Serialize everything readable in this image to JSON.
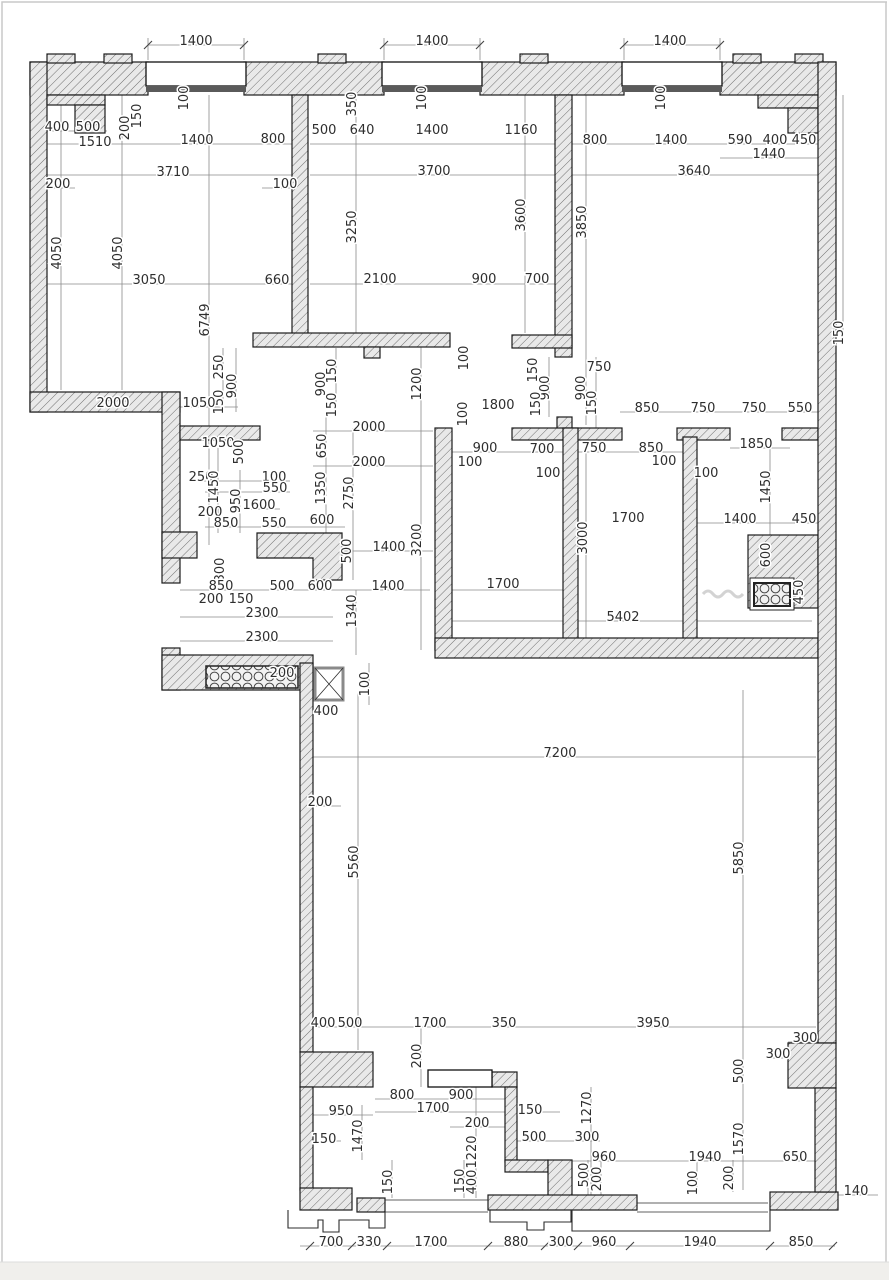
{
  "plan": {
    "kind": "architectural floor plan with dimension chains (mm)",
    "dimension_labels": [
      {
        "t": "1400",
        "x": 196,
        "y": 45
      },
      {
        "t": "1400",
        "x": 432,
        "y": 45
      },
      {
        "t": "1400",
        "x": 670,
        "y": 45
      },
      {
        "t": "100",
        "x": 188,
        "y": 98,
        "v": 1
      },
      {
        "t": "150",
        "x": 141,
        "y": 116,
        "v": 1
      },
      {
        "t": "200",
        "x": 129,
        "y": 128,
        "v": 1
      },
      {
        "t": "400",
        "x": 57,
        "y": 131
      },
      {
        "t": "500",
        "x": 88,
        "y": 131
      },
      {
        "t": "1510",
        "x": 95,
        "y": 146
      },
      {
        "t": "1400",
        "x": 197,
        "y": 144
      },
      {
        "t": "800",
        "x": 273,
        "y": 143
      },
      {
        "t": "350",
        "x": 356,
        "y": 104,
        "v": 1
      },
      {
        "t": "100",
        "x": 426,
        "y": 98,
        "v": 1
      },
      {
        "t": "500",
        "x": 324,
        "y": 134
      },
      {
        "t": "640",
        "x": 362,
        "y": 134
      },
      {
        "t": "1400",
        "x": 432,
        "y": 134
      },
      {
        "t": "1160",
        "x": 521,
        "y": 134
      },
      {
        "t": "800",
        "x": 595,
        "y": 144
      },
      {
        "t": "100",
        "x": 665,
        "y": 98,
        "v": 1
      },
      {
        "t": "1400",
        "x": 671,
        "y": 144
      },
      {
        "t": "590",
        "x": 740,
        "y": 144
      },
      {
        "t": "400",
        "x": 775,
        "y": 144
      },
      {
        "t": "450",
        "x": 804,
        "y": 144
      },
      {
        "t": "1440",
        "x": 769,
        "y": 158
      },
      {
        "t": "3710",
        "x": 173,
        "y": 176
      },
      {
        "t": "3700",
        "x": 434,
        "y": 175
      },
      {
        "t": "3640",
        "x": 694,
        "y": 175
      },
      {
        "t": "200",
        "x": 58,
        "y": 188
      },
      {
        "t": "100",
        "x": 285,
        "y": 188
      },
      {
        "t": "4050",
        "x": 61,
        "y": 253,
        "v": 1
      },
      {
        "t": "4050",
        "x": 122,
        "y": 253,
        "v": 1
      },
      {
        "t": "3250",
        "x": 356,
        "y": 227,
        "v": 1
      },
      {
        "t": "3600",
        "x": 525,
        "y": 215,
        "v": 1
      },
      {
        "t": "3850",
        "x": 586,
        "y": 222,
        "v": 1
      },
      {
        "t": "3050",
        "x": 149,
        "y": 284
      },
      {
        "t": "660",
        "x": 277,
        "y": 284
      },
      {
        "t": "2100",
        "x": 380,
        "y": 283
      },
      {
        "t": "900",
        "x": 484,
        "y": 283
      },
      {
        "t": "700",
        "x": 537,
        "y": 283
      },
      {
        "t": "150",
        "x": 843,
        "y": 333,
        "v": 1
      },
      {
        "t": "6749",
        "x": 209,
        "y": 320,
        "v": 1
      },
      {
        "t": "250",
        "x": 223,
        "y": 367,
        "v": 1
      },
      {
        "t": "900",
        "x": 236,
        "y": 386,
        "v": 1
      },
      {
        "t": "150",
        "x": 223,
        "y": 402,
        "v": 1
      },
      {
        "t": "2000",
        "x": 113,
        "y": 407
      },
      {
        "t": "1050",
        "x": 199,
        "y": 407
      },
      {
        "t": "150",
        "x": 336,
        "y": 371,
        "v": 1
      },
      {
        "t": "900",
        "x": 325,
        "y": 384,
        "v": 1
      },
      {
        "t": "150",
        "x": 336,
        "y": 405,
        "v": 1
      },
      {
        "t": "1200",
        "x": 421,
        "y": 384,
        "v": 1
      },
      {
        "t": "100",
        "x": 468,
        "y": 358,
        "v": 1
      },
      {
        "t": "150",
        "x": 537,
        "y": 370,
        "v": 1
      },
      {
        "t": "900",
        "x": 549,
        "y": 388,
        "v": 1
      },
      {
        "t": "150",
        "x": 540,
        "y": 404,
        "v": 1
      },
      {
        "t": "750",
        "x": 599,
        "y": 371
      },
      {
        "t": "900",
        "x": 585,
        "y": 388,
        "v": 1
      },
      {
        "t": "150",
        "x": 596,
        "y": 403,
        "v": 1
      },
      {
        "t": "850",
        "x": 647,
        "y": 412
      },
      {
        "t": "750",
        "x": 703,
        "y": 412
      },
      {
        "t": "750",
        "x": 754,
        "y": 412
      },
      {
        "t": "550",
        "x": 800,
        "y": 412
      },
      {
        "t": "1050",
        "x": 218,
        "y": 447
      },
      {
        "t": "500",
        "x": 243,
        "y": 452,
        "v": 1
      },
      {
        "t": "2000",
        "x": 369,
        "y": 431
      },
      {
        "t": "650",
        "x": 326,
        "y": 446,
        "v": 1
      },
      {
        "t": "100",
        "x": 467,
        "y": 414,
        "v": 1
      },
      {
        "t": "1800",
        "x": 498,
        "y": 409
      },
      {
        "t": "900",
        "x": 485,
        "y": 452
      },
      {
        "t": "700",
        "x": 542,
        "y": 453
      },
      {
        "t": "750",
        "x": 594,
        "y": 452
      },
      {
        "t": "850",
        "x": 651,
        "y": 452
      },
      {
        "t": "1850",
        "x": 756,
        "y": 448
      },
      {
        "t": "100",
        "x": 470,
        "y": 466
      },
      {
        "t": "100",
        "x": 548,
        "y": 477
      },
      {
        "t": "100",
        "x": 664,
        "y": 465
      },
      {
        "t": "100",
        "x": 706,
        "y": 477
      },
      {
        "t": "2000",
        "x": 369,
        "y": 466
      },
      {
        "t": "250",
        "x": 201,
        "y": 481
      },
      {
        "t": "1450",
        "x": 218,
        "y": 487,
        "v": 1
      },
      {
        "t": "100",
        "x": 274,
        "y": 481
      },
      {
        "t": "550",
        "x": 275,
        "y": 492
      },
      {
        "t": "950",
        "x": 240,
        "y": 501,
        "v": 1
      },
      {
        "t": "1350",
        "x": 325,
        "y": 488,
        "v": 1
      },
      {
        "t": "2750",
        "x": 353,
        "y": 493,
        "v": 1
      },
      {
        "t": "1600",
        "x": 259,
        "y": 509
      },
      {
        "t": "200",
        "x": 210,
        "y": 516
      },
      {
        "t": "850",
        "x": 226,
        "y": 527
      },
      {
        "t": "550",
        "x": 274,
        "y": 527
      },
      {
        "t": "600",
        "x": 322,
        "y": 524
      },
      {
        "t": "1450",
        "x": 770,
        "y": 487,
        "v": 1
      },
      {
        "t": "1700",
        "x": 628,
        "y": 522
      },
      {
        "t": "1400",
        "x": 740,
        "y": 523
      },
      {
        "t": "450",
        "x": 804,
        "y": 523
      },
      {
        "t": "3000",
        "x": 587,
        "y": 538,
        "v": 1
      },
      {
        "t": "3200",
        "x": 421,
        "y": 540,
        "v": 1
      },
      {
        "t": "500",
        "x": 351,
        "y": 551,
        "v": 1
      },
      {
        "t": "1400",
        "x": 389,
        "y": 551
      },
      {
        "t": "300",
        "x": 224,
        "y": 570,
        "v": 1
      },
      {
        "t": "600",
        "x": 770,
        "y": 555,
        "v": 1
      },
      {
        "t": "850",
        "x": 221,
        "y": 590
      },
      {
        "t": "500",
        "x": 282,
        "y": 590
      },
      {
        "t": "600",
        "x": 320,
        "y": 590
      },
      {
        "t": "1400",
        "x": 388,
        "y": 590
      },
      {
        "t": "1700",
        "x": 503,
        "y": 588
      },
      {
        "t": "450",
        "x": 803,
        "y": 592,
        "v": 1
      },
      {
        "t": "200",
        "x": 211,
        "y": 603
      },
      {
        "t": "150",
        "x": 241,
        "y": 603
      },
      {
        "t": "2300",
        "x": 262,
        "y": 617
      },
      {
        "t": "1340",
        "x": 356,
        "y": 611,
        "v": 1
      },
      {
        "t": "5402",
        "x": 623,
        "y": 621
      },
      {
        "t": "2300",
        "x": 262,
        "y": 641
      },
      {
        "t": "200",
        "x": 282,
        "y": 677
      },
      {
        "t": "100",
        "x": 369,
        "y": 684,
        "v": 1
      },
      {
        "t": "400",
        "x": 326,
        "y": 715
      },
      {
        "t": "7200",
        "x": 560,
        "y": 757
      },
      {
        "t": "200",
        "x": 320,
        "y": 806
      },
      {
        "t": "5560",
        "x": 358,
        "y": 862,
        "v": 1
      },
      {
        "t": "5850",
        "x": 743,
        "y": 858,
        "v": 1
      },
      {
        "t": "300",
        "x": 805,
        "y": 1042
      },
      {
        "t": "300",
        "x": 778,
        "y": 1058
      },
      {
        "t": "400",
        "x": 323,
        "y": 1027
      },
      {
        "t": "500",
        "x": 350,
        "y": 1027
      },
      {
        "t": "1700",
        "x": 430,
        "y": 1027
      },
      {
        "t": "350",
        "x": 504,
        "y": 1027
      },
      {
        "t": "3950",
        "x": 653,
        "y": 1027
      },
      {
        "t": "200",
        "x": 421,
        "y": 1056,
        "v": 1
      },
      {
        "t": "800",
        "x": 402,
        "y": 1099
      },
      {
        "t": "900",
        "x": 461,
        "y": 1099
      },
      {
        "t": "950",
        "x": 341,
        "y": 1115
      },
      {
        "t": "1700",
        "x": 433,
        "y": 1112
      },
      {
        "t": "150",
        "x": 530,
        "y": 1114
      },
      {
        "t": "200",
        "x": 477,
        "y": 1127
      },
      {
        "t": "150",
        "x": 324,
        "y": 1143
      },
      {
        "t": "1470",
        "x": 362,
        "y": 1136,
        "v": 1
      },
      {
        "t": "500",
        "x": 534,
        "y": 1141
      },
      {
        "t": "300",
        "x": 587,
        "y": 1141
      },
      {
        "t": "1270",
        "x": 591,
        "y": 1108,
        "v": 1
      },
      {
        "t": "500",
        "x": 743,
        "y": 1071,
        "v": 1
      },
      {
        "t": "960",
        "x": 604,
        "y": 1161
      },
      {
        "t": "1940",
        "x": 705,
        "y": 1161
      },
      {
        "t": "650",
        "x": 795,
        "y": 1161
      },
      {
        "t": "1570",
        "x": 743,
        "y": 1139,
        "v": 1
      },
      {
        "t": "1220",
        "x": 476,
        "y": 1152,
        "v": 1
      },
      {
        "t": "400",
        "x": 476,
        "y": 1182,
        "v": 1
      },
      {
        "t": "150",
        "x": 464,
        "y": 1181,
        "v": 1
      },
      {
        "t": "150",
        "x": 392,
        "y": 1182,
        "v": 1
      },
      {
        "t": "500",
        "x": 588,
        "y": 1175,
        "v": 1
      },
      {
        "t": "200",
        "x": 601,
        "y": 1179,
        "v": 1
      },
      {
        "t": "100",
        "x": 697,
        "y": 1183,
        "v": 1
      },
      {
        "t": "200",
        "x": 733,
        "y": 1178,
        "v": 1
      },
      {
        "t": "140",
        "x": 856,
        "y": 1195
      },
      {
        "t": "700",
        "x": 331,
        "y": 1246
      },
      {
        "t": "330",
        "x": 369,
        "y": 1246
      },
      {
        "t": "1700",
        "x": 431,
        "y": 1246
      },
      {
        "t": "880",
        "x": 516,
        "y": 1246
      },
      {
        "t": "300",
        "x": 561,
        "y": 1246
      },
      {
        "t": "960",
        "x": 604,
        "y": 1246
      },
      {
        "t": "1940",
        "x": 700,
        "y": 1246
      },
      {
        "t": "850",
        "x": 801,
        "y": 1246
      }
    ]
  }
}
